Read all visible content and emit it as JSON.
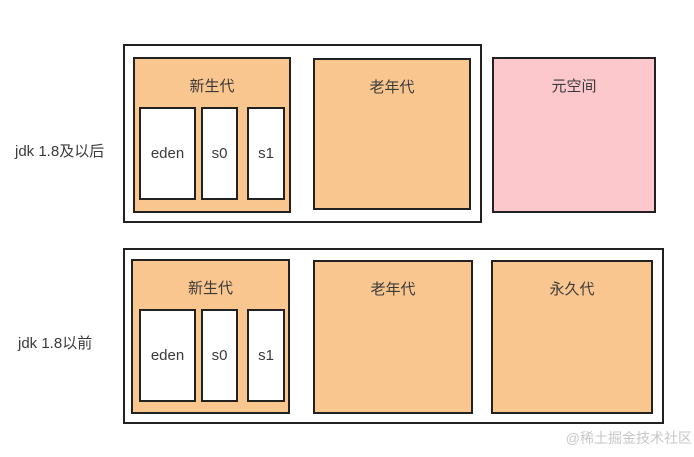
{
  "diagram": {
    "title_hint": "JVM heap memory layout comparison",
    "watermark": "@稀土掘金技术社区",
    "colors": {
      "generation_fill": "#fac68f",
      "metaspace_fill": "#fdc8cc",
      "border": "#212121",
      "text": "#3a3a3a",
      "watermark_text": "#c7c7c7",
      "background": "#ffffff"
    },
    "rows": [
      {
        "label": "jdk 1.8及以后",
        "young_gen": {
          "label": "新生代",
          "regions": [
            "eden",
            "s0",
            "s1"
          ]
        },
        "old_gen_label": "老年代",
        "metaspace_label": "元空间"
      },
      {
        "label": "jdk 1.8以前",
        "young_gen": {
          "label": "新生代",
          "regions": [
            "eden",
            "s0",
            "s1"
          ]
        },
        "old_gen_label": "老年代",
        "perm_gen_label": "永久代"
      }
    ]
  }
}
